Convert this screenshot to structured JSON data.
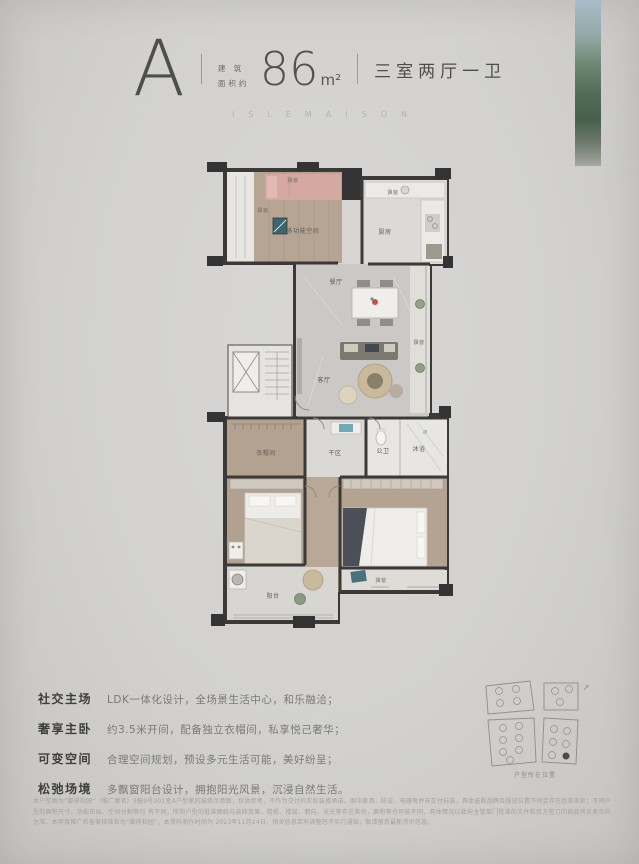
{
  "header": {
    "unit_letter": "A",
    "area_label_top": "建 筑",
    "area_label_bottom": "面积约",
    "area_value": "86",
    "area_unit": "m²",
    "layout_text": "三室两厅一卫",
    "series_name": "ISLEMAISON"
  },
  "plan": {
    "labels": {
      "bay_top": "飘窗",
      "bay_left": "飘窗",
      "multi_room": "多功能空间",
      "kitchen_bay": "飘窗",
      "kitchen": "厨房",
      "dining": "餐厅",
      "living": "客厅",
      "bay_right": "飘窗",
      "closet": "衣帽间",
      "dry_area": "干区",
      "bath": "公卫",
      "shower": "沐浴",
      "balcony": "阳台",
      "bay_bottom": "飘窗"
    }
  },
  "features": [
    {
      "title": "社交主场",
      "desc": "LDK一体化设计，全场景生活中心，和乐融洽；"
    },
    {
      "title": "奢享主卧",
      "desc": "约3.5米开间，配备独立衣帽间，私享悦己奢华；"
    },
    {
      "title": "可变空间",
      "desc": "合理空间规划，预设多元生活可能，美好纷呈；"
    },
    {
      "title": "松弛场境",
      "desc": "多飘窗阳台设计，拥抱阳光风景，沉浸自然生活。"
    }
  ],
  "sitemap": {
    "caption": "户型所在位置",
    "compass_icon": "↗"
  },
  "disclaimer": {
    "lines": [
      "本户型图为“御璟和园”（推广案名）3幢9号301室A户型家的装修示意图，仅供参考，不作为交付的实际装修承诺。图中家具、陈设、电器等并非交付标准，具体选购品牌及摆放位置不同会存在色差差异；不同户型的面积尺寸、功能布局、空间分割等均",
      "有不同，所购户型的批准图纸与装修效果、楼栋、楼层、朝向、采光等存在差别，面积等也可能不同，具体情况以政府主管部门批准的文件和双方签订的商品房买卖合同为准。本项目推广名备案核准名为“御璟和园”，本资料制作时间为",
      "2023年11月24日，相关信息若有调整恕不另行通知，敬请留意最新资讯信息。"
    ]
  },
  "colors": {
    "background": "#d2d1cf",
    "wall": "#3b3a38",
    "wood_floor": "#b5a492",
    "pink_bed": "#d6a8a2",
    "teal_accent": "#4f7f8c",
    "text_dark": "#4a4a4a",
    "text_muted": "#7a7a7a",
    "disclaimer_text": "#a3a2a0"
  }
}
